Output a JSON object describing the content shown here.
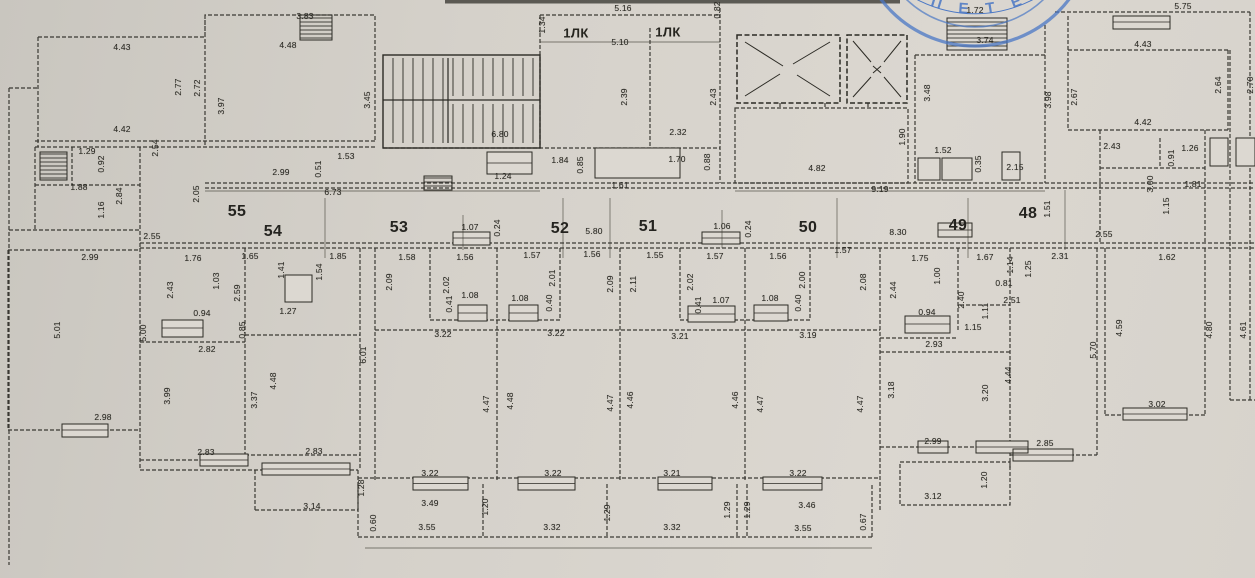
{
  "palette": {
    "paper": "#d5d1ca",
    "ink": "#2b2a24",
    "stamp_blue": "#4a77c5"
  },
  "stamp": {
    "arc_text": "· П Е Т Е Р"
  },
  "plan": {
    "room_numbers": [
      {
        "n": "55",
        "x": 237,
        "y": 212
      },
      {
        "n": "54",
        "x": 273,
        "y": 232
      },
      {
        "n": "53",
        "x": 399,
        "y": 228
      },
      {
        "n": "52",
        "x": 560,
        "y": 229
      },
      {
        "n": "51",
        "x": 648,
        "y": 227
      },
      {
        "n": "50",
        "x": 808,
        "y": 228
      },
      {
        "n": "49",
        "x": 958,
        "y": 226
      },
      {
        "n": "48",
        "x": 1028,
        "y": 214
      }
    ],
    "stair_labels": [
      {
        "t": "1ЛК",
        "x": 576,
        "y": 33
      },
      {
        "t": "1ЛК",
        "x": 668,
        "y": 32
      }
    ],
    "dimensions": [
      [
        "3.83",
        305,
        16
      ],
      [
        "4.43",
        122,
        47
      ],
      [
        "4.48",
        288,
        45
      ],
      [
        "2.77",
        178,
        87,
        "v"
      ],
      [
        "2.72",
        197,
        88,
        "v"
      ],
      [
        "3.97",
        221,
        106,
        "v"
      ],
      [
        "3.45",
        367,
        100,
        "v"
      ],
      [
        "4.42",
        122,
        129
      ],
      [
        "2.54",
        155,
        148,
        "v"
      ],
      [
        "1.29",
        87,
        151
      ],
      [
        "0.92",
        101,
        164,
        "v"
      ],
      [
        "1.88",
        79,
        187
      ],
      [
        "2.84",
        119,
        196,
        "v"
      ],
      [
        "1.16",
        101,
        210,
        "v"
      ],
      [
        "2.05",
        196,
        194,
        "v"
      ],
      [
        "2.99",
        281,
        172
      ],
      [
        "0.51",
        318,
        169,
        "v"
      ],
      [
        "1.53",
        346,
        156
      ],
      [
        "6.73",
        333,
        192
      ],
      [
        "2.55",
        152,
        236
      ],
      [
        "1.24",
        503,
        176
      ],
      [
        "1.34",
        542,
        25,
        "v"
      ],
      [
        "5.16",
        623,
        8
      ],
      [
        "5.10",
        620,
        42
      ],
      [
        "0.82",
        717,
        10,
        "v"
      ],
      [
        "6.80",
        500,
        134
      ],
      [
        "1.84",
        560,
        160
      ],
      [
        "0.85",
        580,
        165,
        "v"
      ],
      [
        "1.61",
        620,
        185
      ],
      [
        "2.39",
        624,
        97,
        "v"
      ],
      [
        "2.43",
        713,
        97,
        "v"
      ],
      [
        "2.32",
        678,
        132
      ],
      [
        "1.70",
        677,
        159
      ],
      [
        "0.88",
        707,
        162,
        "v"
      ],
      [
        "1.72",
        975,
        10
      ],
      [
        "3.74",
        985,
        40
      ],
      [
        "3.48",
        927,
        93,
        "v"
      ],
      [
        "1.90",
        902,
        137,
        "v"
      ],
      [
        "1.52",
        943,
        150
      ],
      [
        "0.35",
        978,
        164,
        "v"
      ],
      [
        "2.15",
        1015,
        167
      ],
      [
        "4.82",
        817,
        168
      ],
      [
        "9.19",
        880,
        189
      ],
      [
        "3.98",
        1048,
        100,
        "v"
      ],
      [
        "5.75",
        1183,
        6
      ],
      [
        "4.43",
        1143,
        44
      ],
      [
        "2.67",
        1074,
        97,
        "v"
      ],
      [
        "2.64",
        1218,
        85,
        "v"
      ],
      [
        "2.70",
        1250,
        85,
        "v"
      ],
      [
        "4.42",
        1143,
        122
      ],
      [
        "2.43",
        1112,
        146
      ],
      [
        "1.26",
        1190,
        148
      ],
      [
        "0.91",
        1171,
        158,
        "v"
      ],
      [
        "1.81",
        1193,
        184
      ],
      [
        "3.00",
        1150,
        184,
        "v"
      ],
      [
        "1.15",
        1166,
        206,
        "v"
      ],
      [
        "2.55",
        1104,
        234
      ],
      [
        "1.51",
        1047,
        209,
        "v"
      ],
      [
        "1.07",
        470,
        227
      ],
      [
        "0.24",
        497,
        228,
        "v"
      ],
      [
        "5.80",
        594,
        231
      ],
      [
        "1.06",
        722,
        226
      ],
      [
        "0.24",
        748,
        229,
        "v"
      ],
      [
        "8.30",
        898,
        232
      ],
      [
        "1.76",
        193,
        258
      ],
      [
        "1.65",
        250,
        256
      ],
      [
        "1.85",
        338,
        256
      ],
      [
        "2.43",
        170,
        290,
        "v"
      ],
      [
        "1.03",
        216,
        281,
        "v"
      ],
      [
        "2.59",
        237,
        293,
        "v"
      ],
      [
        "1.41",
        281,
        270,
        "v"
      ],
      [
        "1.54",
        319,
        272,
        "v"
      ],
      [
        "0.94",
        202,
        313
      ],
      [
        "0.85",
        242,
        330,
        "v"
      ],
      [
        "1.27",
        288,
        311
      ],
      [
        "2.82",
        207,
        349
      ],
      [
        "1.58",
        407,
        257
      ],
      [
        "1.56",
        465,
        257
      ],
      [
        "2.09",
        389,
        282,
        "v"
      ],
      [
        "2.02",
        446,
        285,
        "v"
      ],
      [
        "0.41",
        449,
        304,
        "v"
      ],
      [
        "1.08",
        470,
        295
      ],
      [
        "1.57",
        532,
        255
      ],
      [
        "2.01",
        552,
        278,
        "v"
      ],
      [
        "0.40",
        549,
        303,
        "v"
      ],
      [
        "1.08",
        520,
        298
      ],
      [
        "1.56",
        592,
        254
      ],
      [
        "2.09",
        610,
        284,
        "v"
      ],
      [
        "1.55",
        655,
        255
      ],
      [
        "2.11",
        633,
        284,
        "v"
      ],
      [
        "1.57",
        715,
        256
      ],
      [
        "2.02",
        690,
        282,
        "v"
      ],
      [
        "0.41",
        698,
        305,
        "v"
      ],
      [
        "1.07",
        721,
        300
      ],
      [
        "1.56",
        778,
        256
      ],
      [
        "2.00",
        802,
        280,
        "v"
      ],
      [
        "0.40",
        798,
        303,
        "v"
      ],
      [
        "1.08",
        770,
        298
      ],
      [
        "1.57",
        843,
        250
      ],
      [
        "2.08",
        863,
        282,
        "v"
      ],
      [
        "3.22",
        443,
        334
      ],
      [
        "3.22",
        556,
        333
      ],
      [
        "3.21",
        680,
        336
      ],
      [
        "3.19",
        808,
        335
      ],
      [
        "1.75",
        920,
        258
      ],
      [
        "1.67",
        985,
        257
      ],
      [
        "1.14",
        1010,
        265,
        "v"
      ],
      [
        "1.25",
        1028,
        269,
        "v"
      ],
      [
        "2.31",
        1060,
        256
      ],
      [
        "1.62",
        1167,
        257
      ],
      [
        "2.44",
        893,
        290,
        "v"
      ],
      [
        "1.00",
        937,
        276,
        "v"
      ],
      [
        "2.40",
        961,
        300,
        "v"
      ],
      [
        "0.81",
        1004,
        283
      ],
      [
        "2.51",
        1012,
        300
      ],
      [
        "1.11",
        985,
        311,
        "v"
      ],
      [
        "1.15",
        973,
        327
      ],
      [
        "0.94",
        927,
        312
      ],
      [
        "2.93",
        934,
        344
      ],
      [
        "2.99",
        90,
        257
      ],
      [
        "5.01",
        57,
        330,
        "v"
      ],
      [
        "2.98",
        103,
        417
      ],
      [
        "5.00",
        143,
        333,
        "v"
      ],
      [
        "3.99",
        167,
        396,
        "v"
      ],
      [
        "3.37",
        254,
        400,
        "v"
      ],
      [
        "4.48",
        273,
        381,
        "v"
      ],
      [
        "6.01",
        363,
        355,
        "v"
      ],
      [
        "2.83",
        206,
        452
      ],
      [
        "2.83",
        314,
        451
      ],
      [
        "3.14",
        312,
        506
      ],
      [
        "1.28",
        361,
        488,
        "v"
      ],
      [
        "4.47",
        486,
        404,
        "v"
      ],
      [
        "4.48",
        510,
        401,
        "v"
      ],
      [
        "4.47",
        610,
        403,
        "v"
      ],
      [
        "4.46",
        630,
        400,
        "v"
      ],
      [
        "4.46",
        735,
        400,
        "v"
      ],
      [
        "4.47",
        760,
        404,
        "v"
      ],
      [
        "4.47",
        860,
        404,
        "v"
      ],
      [
        "3.18",
        891,
        390,
        "v"
      ],
      [
        "3.20",
        985,
        393,
        "v"
      ],
      [
        "4.44",
        1008,
        375,
        "v"
      ],
      [
        "2.99",
        933,
        441
      ],
      [
        "3.12",
        933,
        496
      ],
      [
        "1.20",
        984,
        480,
        "v"
      ],
      [
        "5.70",
        1093,
        350,
        "v"
      ],
      [
        "4.59",
        1119,
        328,
        "v"
      ],
      [
        "4.80",
        1209,
        330,
        "v"
      ],
      [
        "4.61",
        1243,
        330,
        "v"
      ],
      [
        "3.02",
        1157,
        404
      ],
      [
        "2.85",
        1045,
        443
      ],
      [
        "3.22",
        430,
        473
      ],
      [
        "3.49",
        430,
        503
      ],
      [
        "0.60",
        373,
        523,
        "v"
      ],
      [
        "3.55",
        427,
        527
      ],
      [
        "1.20",
        485,
        507,
        "v"
      ],
      [
        "3.22",
        553,
        473
      ],
      [
        "3.32",
        552,
        527
      ],
      [
        "1.29",
        607,
        513,
        "v"
      ],
      [
        "3.21",
        672,
        473
      ],
      [
        "3.32",
        672,
        527
      ],
      [
        "1.29",
        727,
        510,
        "v"
      ],
      [
        "1.29",
        747,
        510,
        "v"
      ],
      [
        "3.22",
        798,
        473
      ],
      [
        "3.46",
        807,
        505
      ],
      [
        "3.55",
        803,
        528
      ],
      [
        "0.67",
        863,
        522,
        "v"
      ]
    ]
  }
}
